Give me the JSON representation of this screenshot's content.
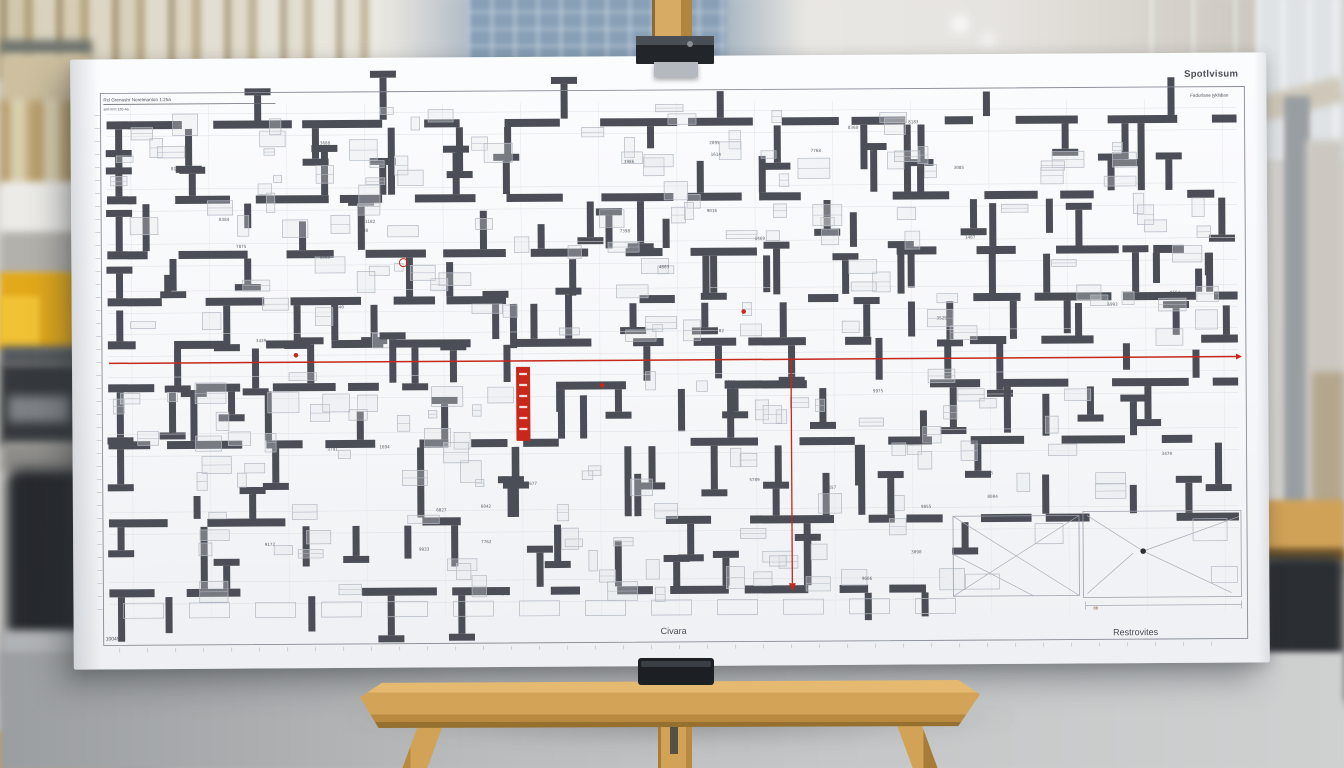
{
  "scene": {
    "width": 1344,
    "height": 768,
    "description": "architectural floor plan poster on wooden easel in blurred office atrium"
  },
  "palette": {
    "red": "#c8271b",
    "wall": "#4b4e56",
    "thin": "#b3b9c4",
    "board": "#f8f9fb",
    "wood": "#d2a257",
    "accent_yellow": "#e2a91a"
  },
  "board": {
    "texts": {
      "title_topleft": "Rcl Grenashr Norelmanton 1:25a",
      "title_sub": "sml-nrm 120-4a",
      "brand": "Spotlvisum",
      "brand_sub": "Fadurlane jyklidian",
      "bottom_center": "Civara",
      "bottom_right": "Restrovites",
      "bottom_left": "10049"
    }
  },
  "plan": {
    "seed": 20240817,
    "frame": {
      "x": 30,
      "y": 34,
      "w": 1144,
      "h": 552
    },
    "grid": {
      "x1": 60,
      "x2": 1160,
      "step": 78,
      "y1": 46,
      "y2": 560
    },
    "bands": [
      {
        "x1": 36,
        "x2": 1166,
        "yTop": 48,
        "yBottom": 298,
        "tall": 11,
        "furniture": 120,
        "labels": 26,
        "rows": [
          {
            "y": 66
          },
          {
            "y": 141
          },
          {
            "y": 196
          },
          {
            "y": 243
          },
          {
            "y": 286
          }
        ]
      },
      {
        "x1": 36,
        "x2": 1166,
        "yTop": 312,
        "yBottom": 556,
        "tall": 9,
        "furniture": 100,
        "labels": 22,
        "exclude": {
          "x": 872,
          "y": 450
        },
        "rows": [
          {
            "y": 329
          },
          {
            "y": 386
          },
          {
            "y": 464
          },
          {
            "y": 534,
            "x2": 872
          }
        ]
      }
    ],
    "footer": {
      "x1": 50,
      "x2": 868,
      "y": 544,
      "step": 66,
      "w": 40,
      "h": 15
    },
    "zones": [
      {
        "x": 880,
        "y": 462,
        "w": 126,
        "h": 80,
        "lines": [
          [
            880,
            462,
            1006,
            542
          ],
          [
            880,
            542,
            1006,
            462
          ],
          [
            880,
            500,
            960,
            542
          ]
        ],
        "rects": [
          [
            892,
            520,
            34,
            15
          ],
          [
            962,
            470,
            28,
            20
          ]
        ]
      },
      {
        "x": 1010,
        "y": 458,
        "w": 158,
        "h": 86,
        "lines": [
          [
            1014,
            462,
            1070,
            498
          ],
          [
            1166,
            464,
            1070,
            498
          ],
          [
            1070,
            498,
            1158,
            540
          ],
          [
            1014,
            540,
            1060,
            500
          ]
        ],
        "rects": [
          [
            1120,
            466,
            34,
            22
          ],
          [
            1138,
            514,
            26,
            16
          ]
        ],
        "dot": [
          1070,
          498
        ]
      }
    ],
    "red": {
      "hline": {
        "x1": 37,
        "y": 304,
        "x2": 1164
      },
      "vline": {
        "x": 719,
        "y1": 304,
        "y2": 528
      },
      "banner": {
        "x": 444,
        "y": 310,
        "w": 14,
        "h": 74
      },
      "dots": [
        [
          224,
          297
        ],
        [
          672,
          256
        ],
        [
          530,
          329
        ]
      ],
      "circle": [
        332,
        205
      ],
      "tick": [
        1020,
        556
      ],
      "tick_text": "88"
    }
  }
}
